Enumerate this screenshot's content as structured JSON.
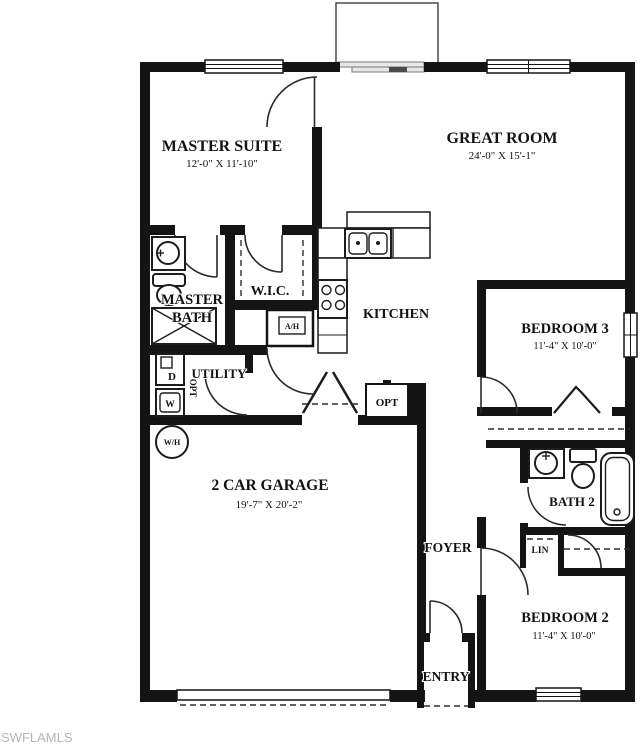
{
  "watermark": "SWFLAMLS",
  "colors": {
    "wall": "#141414",
    "background": "#ffffff",
    "watermark_gray": "#b5b5b5"
  },
  "rooms": {
    "master_suite": {
      "name": "MASTER SUITE",
      "dims": "12'-0\" X 11'-10\""
    },
    "great_room": {
      "name": "GREAT ROOM",
      "dims": "24'-0\" X 15'-1\""
    },
    "master_bath": {
      "line1": "MASTER",
      "line2": "BATH"
    },
    "wic": {
      "name": "W.I.C."
    },
    "kitchen": {
      "name": "KITCHEN"
    },
    "utility": {
      "name": "UTILITY"
    },
    "garage": {
      "name": "2 CAR GARAGE",
      "dims": "19'-7\" X 20'-2\""
    },
    "bedroom3": {
      "name": "BEDROOM 3",
      "dims": "11'-4\" X 10'-0\""
    },
    "bath2": {
      "name": "BATH 2"
    },
    "bedroom2": {
      "name": "BEDROOM 2",
      "dims": "11'-4\" X 10'-0\""
    },
    "foyer": {
      "name": "FOYER"
    },
    "entry": {
      "name": "ENTRY"
    },
    "linen": {
      "name": "LIN"
    }
  },
  "fixtures": {
    "dryer": "D",
    "washer": "W",
    "water_heater": "W/H",
    "air_handler": "A/H",
    "optional_pantry": "OPT",
    "optional_side": "OPT"
  }
}
